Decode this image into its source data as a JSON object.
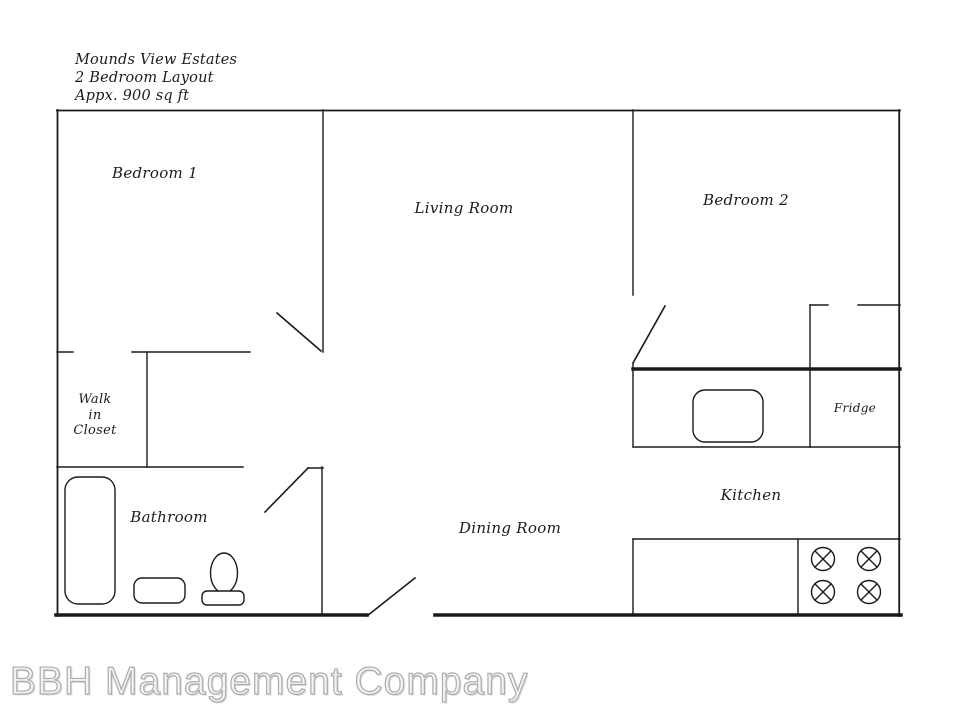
{
  "title": {
    "line1": "Mounds View Estates",
    "line2": "2 Bedroom Layout",
    "line3": "Appx. 900 sq ft"
  },
  "rooms": {
    "bedroom1": "Bedroom 1",
    "living_room": "Living Room",
    "bedroom2": "Bedroom 2",
    "walk_in_closet": {
      "line1": "Walk",
      "line2": "in",
      "line3": "Closet"
    },
    "bathroom": "Bathroom",
    "dining_room": "Dining Room",
    "kitchen": "Kitchen"
  },
  "appliances": {
    "fridge": "Fridge"
  },
  "fixtures": [
    "bathtub",
    "bathroom-sink",
    "toilet",
    "kitchen-sink",
    "stove-burners",
    "fridge-area",
    "pantry-cabinet"
  ],
  "doors": [
    "bedroom1-door",
    "bedroom2-door",
    "bathroom-door",
    "entry-door"
  ],
  "watermark": "BBH Management Company",
  "colors": {
    "wall": "#1a1a1a",
    "background": "#ffffff",
    "watermark_outline": "#acacac"
  }
}
